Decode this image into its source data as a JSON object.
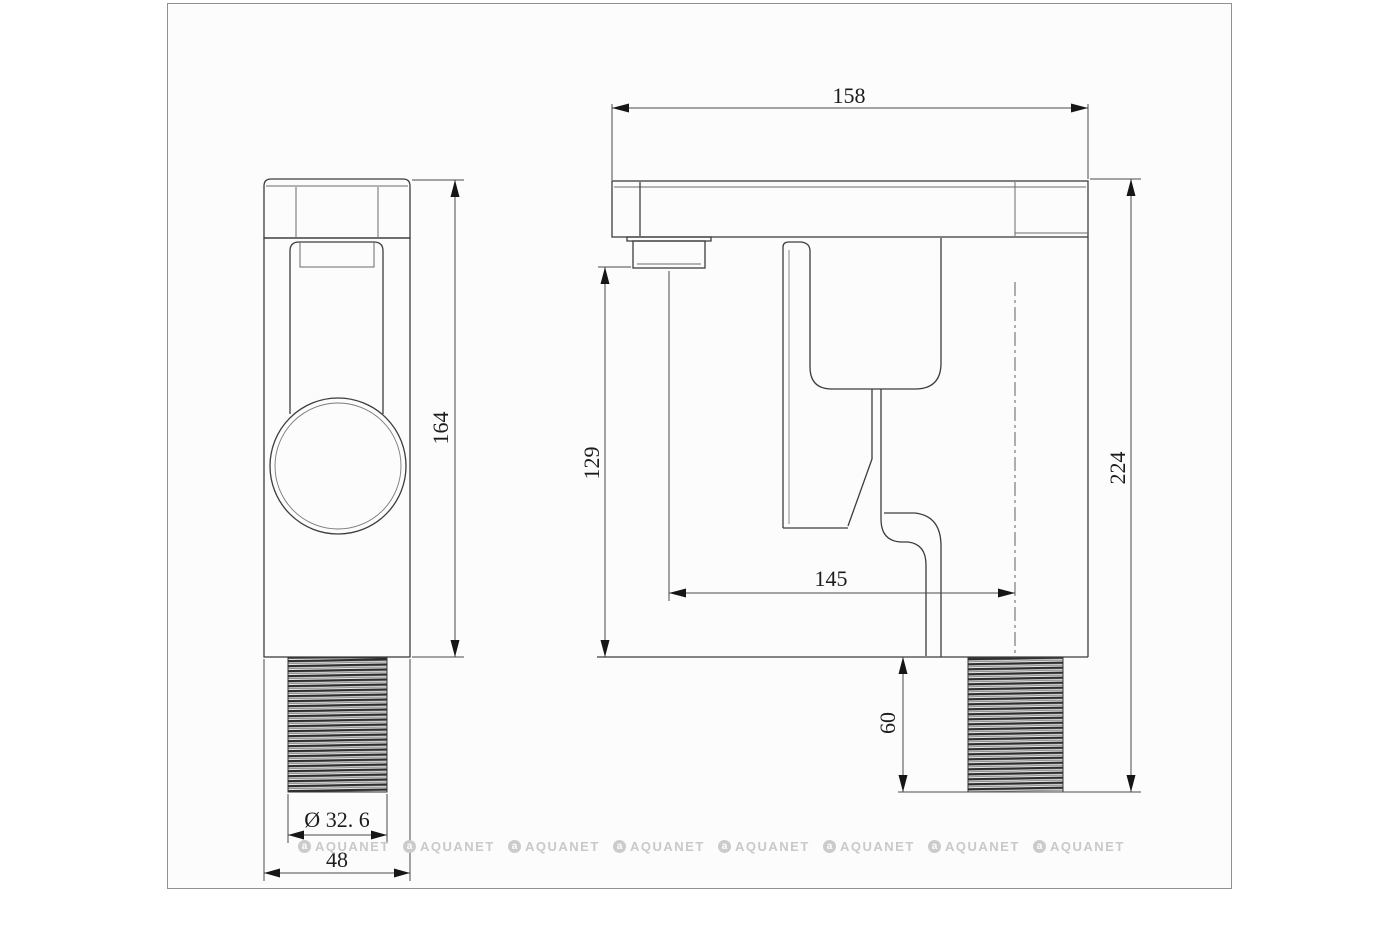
{
  "watermark": {
    "brand": "AQUANET",
    "logo_letter": "a"
  },
  "front_view": {
    "height": "164",
    "width": "48",
    "thread_diameter": "Ø 32. 6"
  },
  "side_view": {
    "top_length": "158",
    "overall_height": "224",
    "spout_height": "129",
    "spout_reach": "145",
    "thread_length": "60"
  },
  "colors": {
    "line": "#3c3c3c",
    "thin_line": "#6a6a6a",
    "text": "#1c1c1c",
    "watermark": "#c9c9c9",
    "canvas_border": "#919191"
  }
}
